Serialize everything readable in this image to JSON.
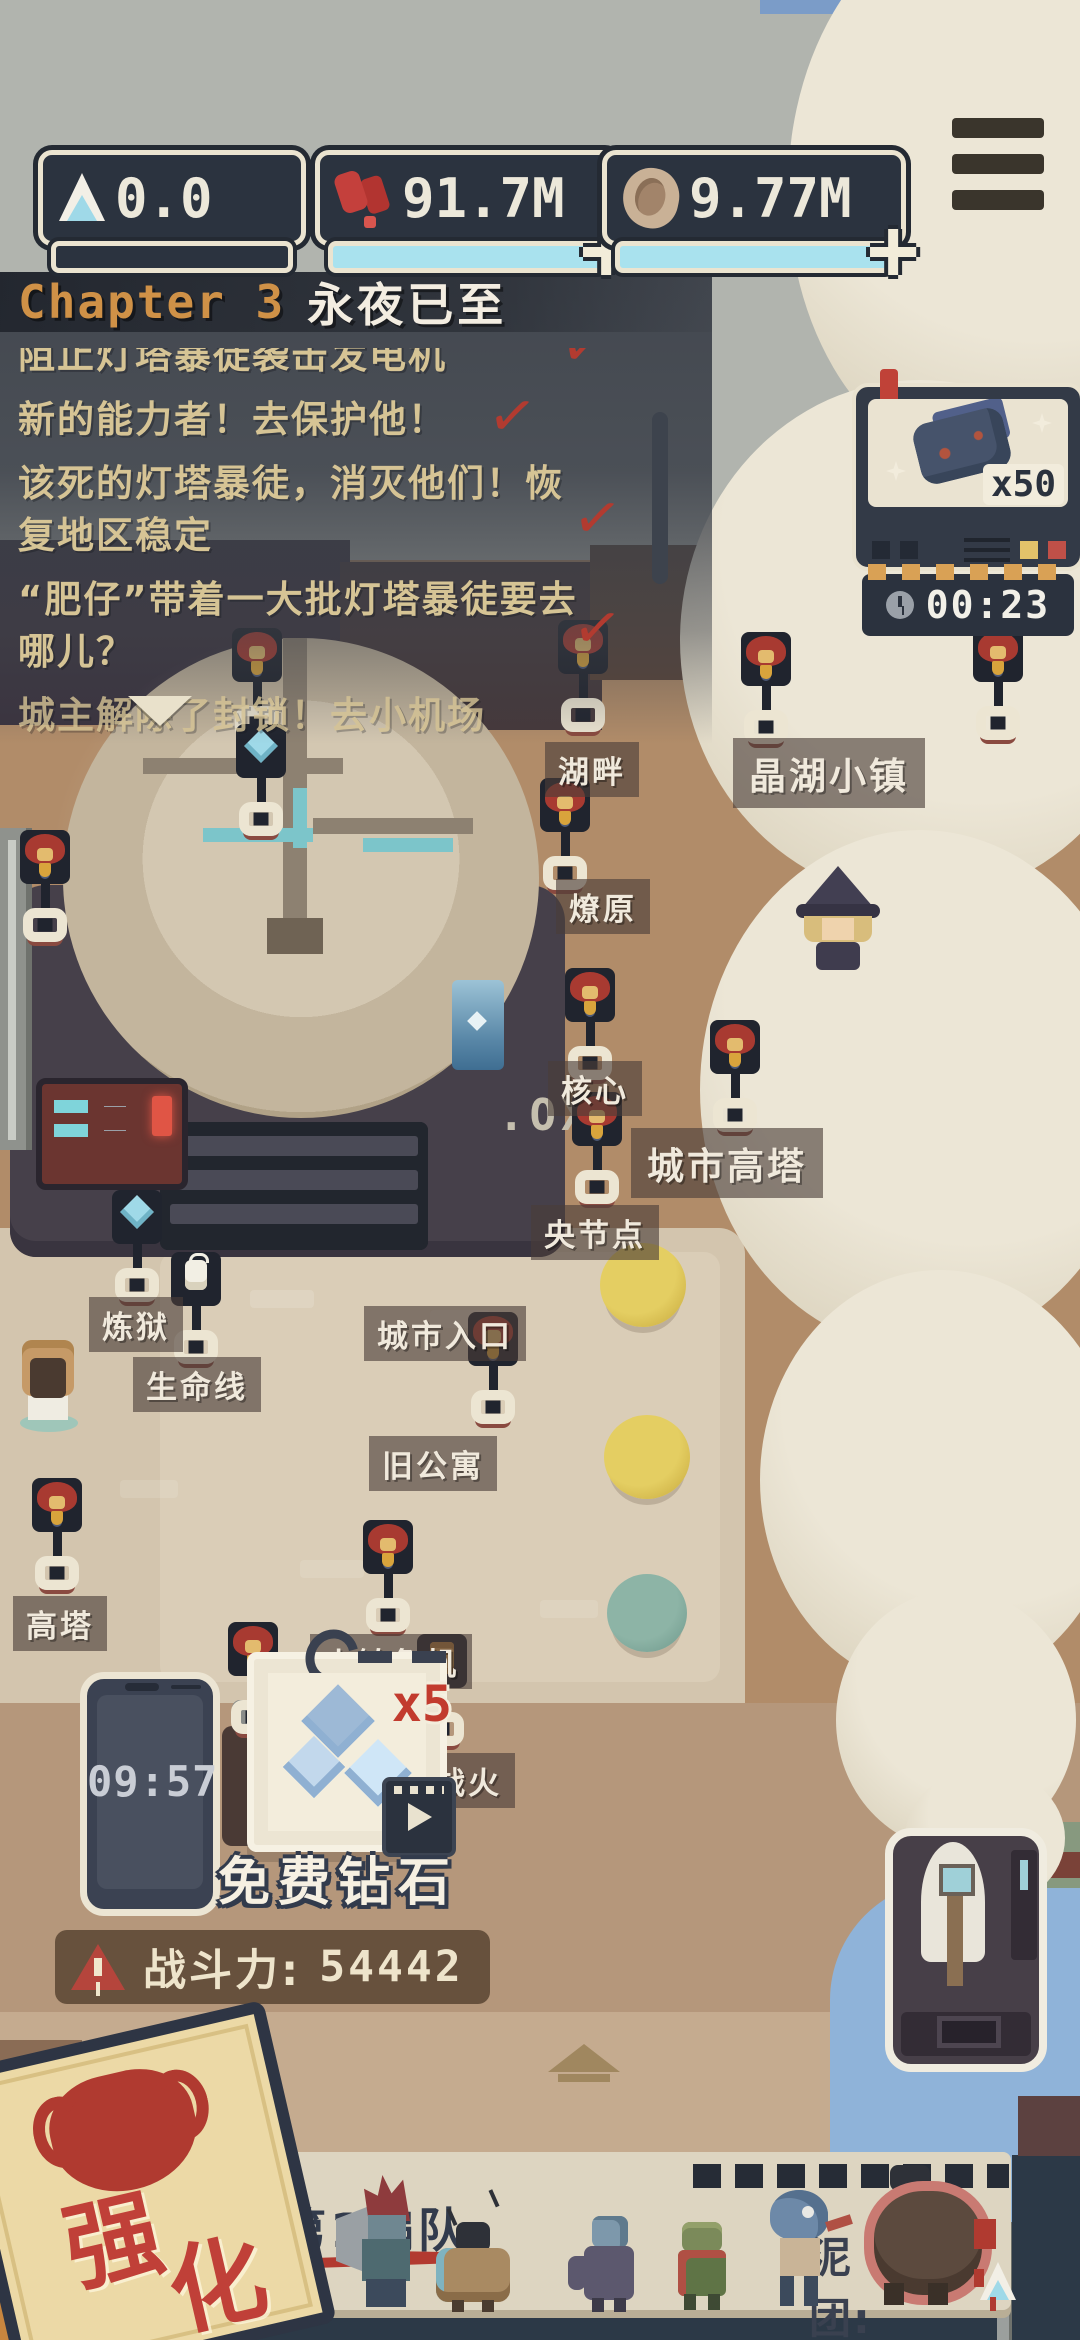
{
  "hud": {
    "resources": [
      {
        "name": "ice",
        "value": "0.0"
      },
      {
        "name": "red-gems",
        "value": "91.7M"
      },
      {
        "name": "shells",
        "value": "9.77M"
      }
    ]
  },
  "icons": {
    "plus": "+",
    "check": "✓"
  },
  "quest_panel": {
    "chapter_label": "Chapter 3",
    "chapter_title": "永夜已至",
    "quests": [
      {
        "text": "阻止灯塔暴徒袭击发电机",
        "completed": true
      },
      {
        "text": "新的能力者！去保护他！",
        "completed": true
      },
      {
        "text": "该死的灯塔暴徒，消灭他们！恢复地区稳定",
        "completed": true
      },
      {
        "text": "“肥仔”带着一大批灯塔暴徒要去哪儿？",
        "completed": true
      },
      {
        "text": "城主解除了封锁！去小机场",
        "completed": false
      }
    ]
  },
  "ad_reward": {
    "quantity": "x50",
    "timer": "00:23"
  },
  "map": {
    "building_sign": ".OXE",
    "labels": {
      "lakeside": "湖畔",
      "crystal_lake_town": "晶湖小镇",
      "prairie_fire": "燎原",
      "core": "核心",
      "city_tower": "城市高塔",
      "central_node": "央节点",
      "purgatory": "炼狱",
      "lifeline": "生命线",
      "city_entrance": "城市入口",
      "old_apartment": "旧公寓",
      "high_tower": "高塔",
      "town_crisis": "小镇危机",
      "town_war": "镇战火"
    }
  },
  "phone": {
    "time": "09:57"
  },
  "free_diamonds": {
    "label": "免费钻石",
    "multiplier": "x5"
  },
  "combat_power": {
    "label": "战斗力:",
    "value": "54442"
  },
  "squad_panel": {
    "title": "第1编队",
    "resource_label": "泥团:",
    "resource_value": "25"
  },
  "enhance_stamp": {
    "char1": "强",
    "char2": "化"
  }
}
